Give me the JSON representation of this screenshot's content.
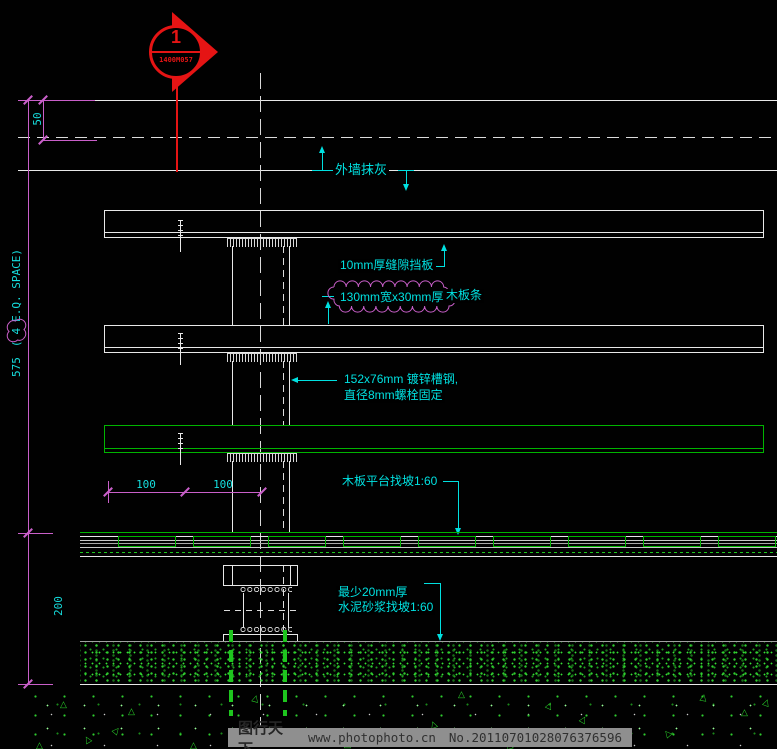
{
  "drawing": {
    "callout": {
      "number": "1",
      "code": "1400M057"
    },
    "dims": {
      "offset50": "50",
      "total575": "575",
      "eq_open": "(",
      "eq_num": "4",
      "eq_rest": "E.Q. SPACE)",
      "depth200": "200",
      "span_left": "100",
      "span_right": "100"
    },
    "notes": {
      "wall_finish": "外墙抹灰",
      "gap_board": "10mm厚缝隙挡板",
      "plank_size": "130mm宽x30mm厚",
      "plank_name": "木板条",
      "channel1": "152x76mm 镀锌槽钢,",
      "channel2": "直径8mm螺栓固定",
      "platform_slope": "木板平台找坡1:60",
      "mortar1": "最少20mm厚",
      "mortar2": "水泥砂浆找坡1:60"
    },
    "ground": {
      "triangle_glyph": "△"
    }
  },
  "watermark": {
    "brand": "图行天下",
    "site": "www.photophoto.cn",
    "serial": "No.20110701028076376596"
  },
  "colors": {
    "background": "#000000",
    "line_white": "#e8e8e8",
    "line_green": "#00b400",
    "speckle_green": "#2ecc2e",
    "dim_magenta": "#c95fc9",
    "text_cyan": "#00e0e0",
    "accent_red": "#e51414",
    "watermark_bar": "#8f8f8f",
    "watermark_text": "#2e2e2e"
  }
}
